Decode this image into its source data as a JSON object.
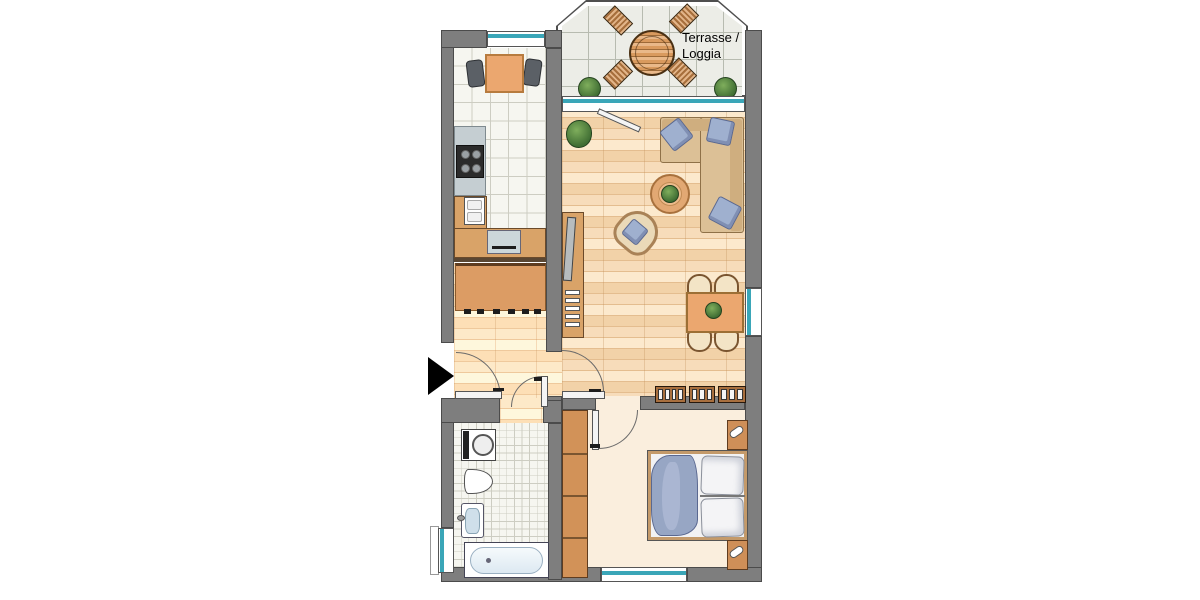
{
  "terrace": {
    "label_line1": "Terrasse /",
    "label_line2": "Loggia"
  },
  "colors": {
    "wall": "#7e7e7e",
    "walledge": "#4b4b4b",
    "teal": "#3aa6b8",
    "wood": "#d9a368",
    "wooddark": "#6b4a2a",
    "orange": "#eba76f",
    "sofa": "#dcc096",
    "sofaback": "#cfae7f",
    "sofaedge": "#8f7148",
    "pillow": "#9fb0cf",
    "pillowedge": "#5a6890",
    "parquet": "#f7dcba",
    "parquetlight": "#fce9cd",
    "parquetmid": "#f2d2a8",
    "seam": "#e4bd8f",
    "bedfloor": "#faeedd",
    "tile": "#f6f6f0",
    "tileline": "#cdcdc2",
    "ttile": "#ecede7",
    "ttline": "#b7bbb0",
    "counter": "#c5ced2",
    "green1": "#7fae5c",
    "green2": "#3f6d33"
  }
}
